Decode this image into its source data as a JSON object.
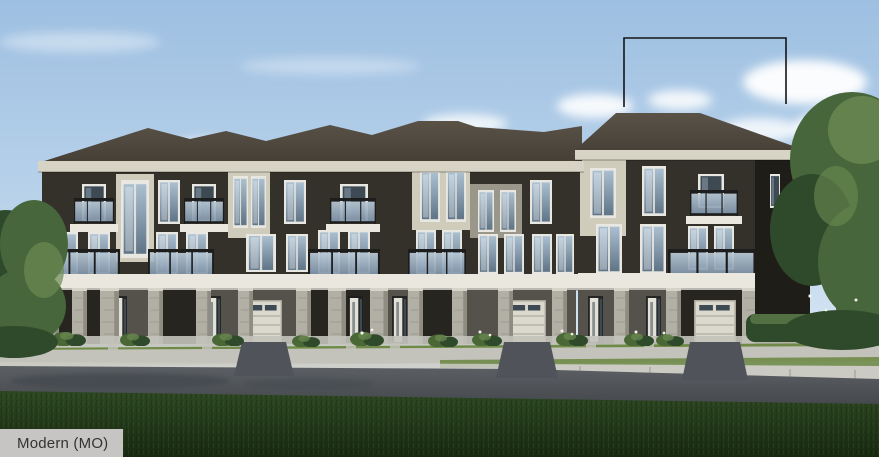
{
  "caption": {
    "label": "Modern (MO)"
  },
  "callout": {
    "points": "624,107 624,38 786,38 786,104"
  },
  "palette": {
    "sky_top": "#9dbfe1",
    "sky_mid": "#bdd5ec",
    "sky_low": "#e2edf6",
    "cloud": "#ffffff",
    "roof": "#453f36",
    "roof_lit": "#5a5247",
    "eave": "#d8d4c5",
    "wall_dark": "#34302a",
    "wall_darker": "#1f1d18",
    "wall_cream": "#cfccbc",
    "wall_gray": "#9a978a",
    "stone": "#b2afa5",
    "stone_dark": "#8f8c82",
    "band_white": "#e9e7de",
    "glass_top": "#b9c9d6",
    "glass_bottom": "#7e93a8",
    "frame_dark": "#1d1d1d",
    "window_frame": "#e8e7e1",
    "window_glass_top": "#aabfd0",
    "window_glass_bottom": "#5f7486",
    "door_white": "#e4e2d8",
    "garage_door": "#dbd9cd",
    "porch_shadow": "#27251f",
    "ground_wall": "#54524a",
    "road": "#5c6064",
    "road_dark": "#45494d",
    "road_wet": "#3f444c",
    "sidewalk": "#c3c3bb",
    "curb": "#cbcbc3",
    "grass_boulevard": "#6f8a47",
    "grass_fg_top": "#2e4823",
    "grass_fg_bottom": "#182a10",
    "tree_green": "#47663b",
    "tree_dark": "#2f4a2b",
    "tree_light": "#6b8a52",
    "bush": "#4a6836",
    "flower_white": "#f2f2ea",
    "label_bg": "#c6c5c3",
    "label_text": "#333333",
    "callout_stroke": "#151515"
  }
}
